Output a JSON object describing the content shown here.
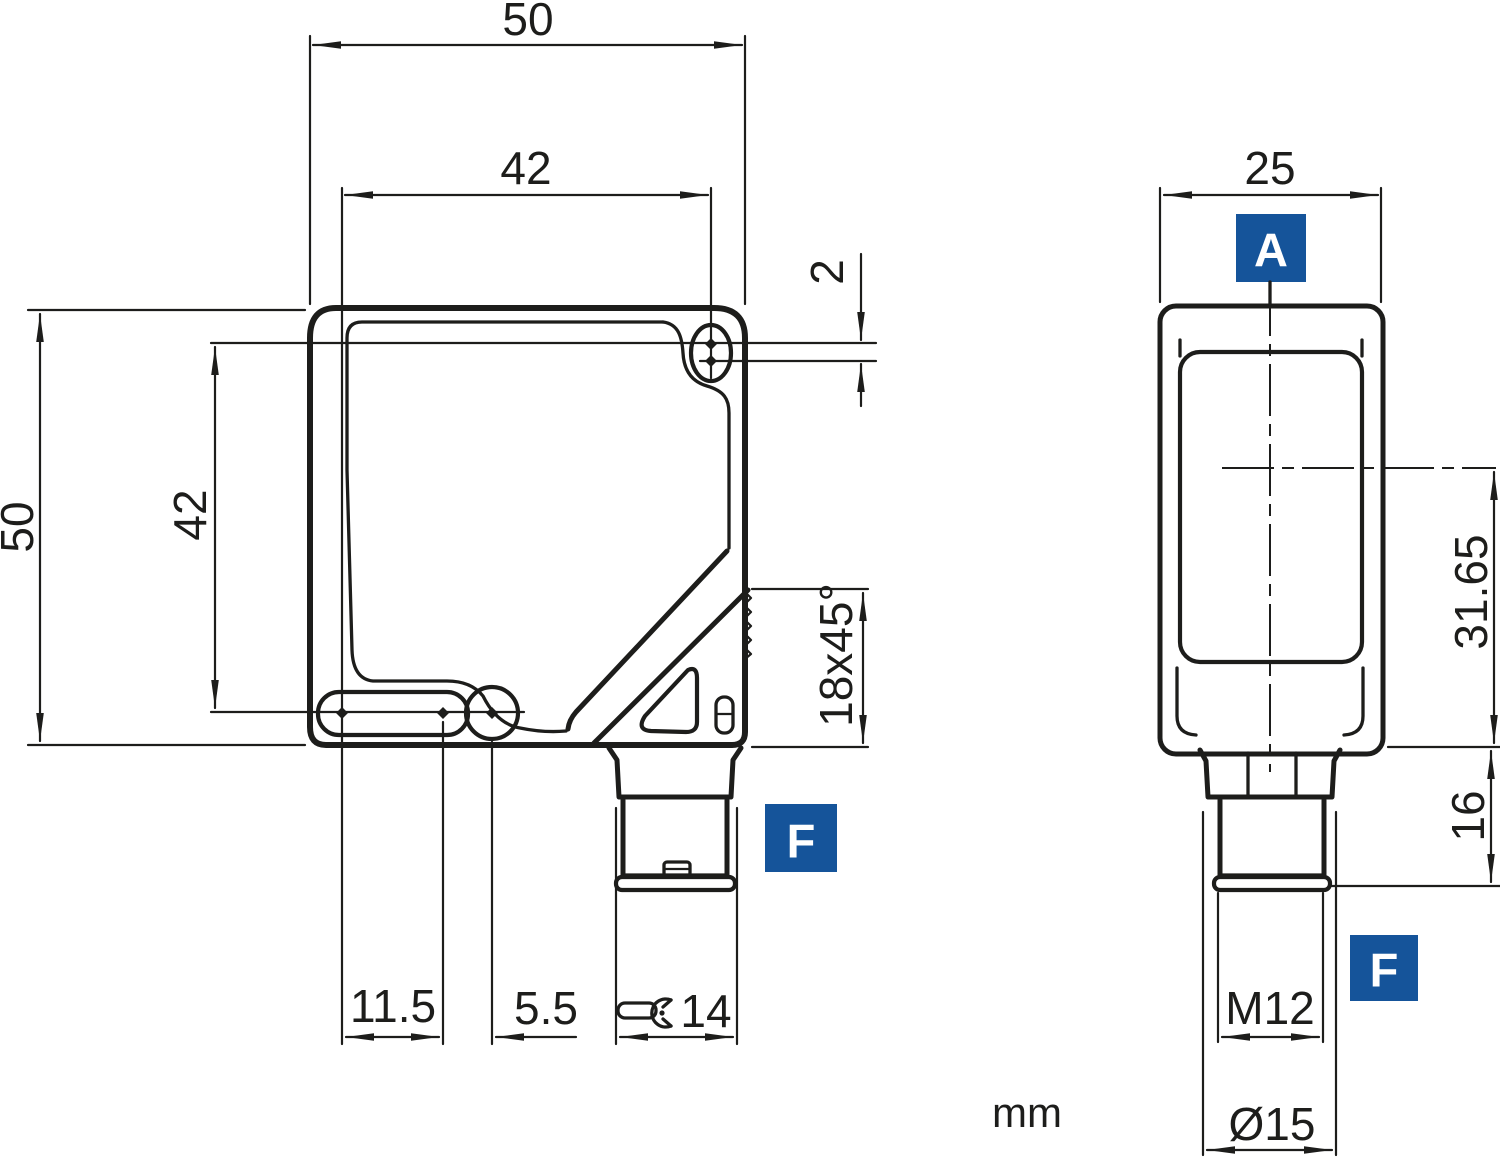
{
  "drawing": {
    "unit_label": "mm",
    "front_view": {
      "width": "50",
      "hole_pitch_horizontal": "42",
      "height": "50",
      "hole_pitch_vertical": "42",
      "hole_offset": "2",
      "chamfer": "18x45°",
      "slot_pitch": "11.5",
      "slot_to_hole": "5.5",
      "wrench_size": "14",
      "connector_label": "F"
    },
    "side_view": {
      "depth": "25",
      "section_label": "A",
      "optical_axis_height": "31.65",
      "connector_length": "16",
      "thread_size": "M12",
      "collar_diameter": "Ø15",
      "connector_label": "F"
    },
    "colors": {
      "badge": "#15549a",
      "line": "#1d1d1b",
      "background": "#ffffff"
    }
  }
}
